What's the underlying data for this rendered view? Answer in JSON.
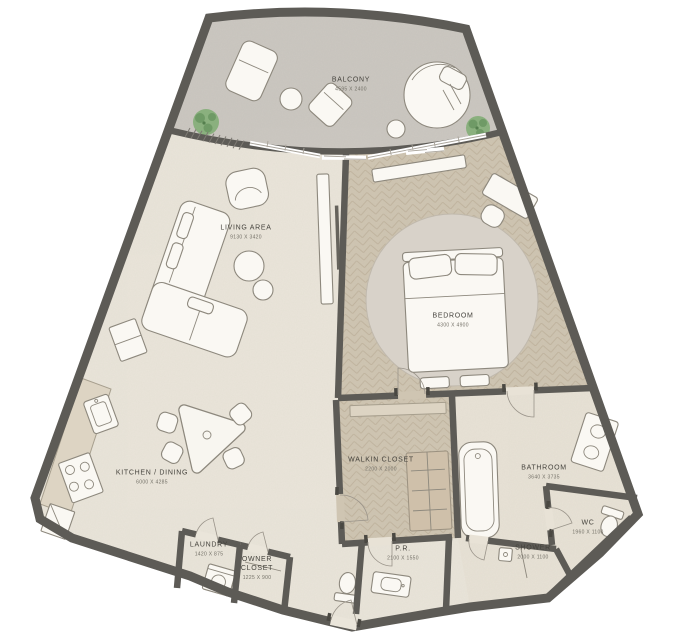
{
  "plan": {
    "rooms": [
      {
        "id": "balcony",
        "name": "BALCONY",
        "dims": "4595 X 2400"
      },
      {
        "id": "living-area",
        "name": "LIVING AREA",
        "dims": "9130 X 3420"
      },
      {
        "id": "bedroom",
        "name": "BEDROOM",
        "dims": "4300 X 4900"
      },
      {
        "id": "kitchen-dining",
        "name": "KITCHEN / DINING",
        "dims": "6000 X 4285"
      },
      {
        "id": "walkin-closet",
        "name": "WALKIN CLOSET",
        "dims": "2200 X 2000"
      },
      {
        "id": "bathroom",
        "name": "BATHROOM",
        "dims": "3640 X 3735"
      },
      {
        "id": "laundry",
        "name": "LAUNDRY",
        "dims": "1420 X 875"
      },
      {
        "id": "owner-closet",
        "name": "OWNER CLOSET",
        "dims": "1225 X 900"
      },
      {
        "id": "powder-room",
        "name": "P.R.",
        "dims": "2100 X 1550"
      },
      {
        "id": "shower",
        "name": "SHOWER",
        "dims": "2000 X 1100"
      },
      {
        "id": "wc",
        "name": "WC",
        "dims": "1960 X 1100"
      }
    ],
    "colors": {
      "wall": "#5d5b56",
      "floor-main": "#eae5da",
      "floor-balcony": "#cbc7c1",
      "floor-wood": "#cfc5b2",
      "wood-line": "#bfb29c",
      "floor-bath": "#e8e2d6",
      "rug": "#d8d2c9",
      "furniture": "#faf8f3",
      "furniture-line": "#8d887d",
      "counter": "#ddd4c3",
      "wardrobe": "#cfc0aa",
      "plant": "#8ab07e",
      "label": "#45433d",
      "label-dim": "#737067"
    }
  }
}
